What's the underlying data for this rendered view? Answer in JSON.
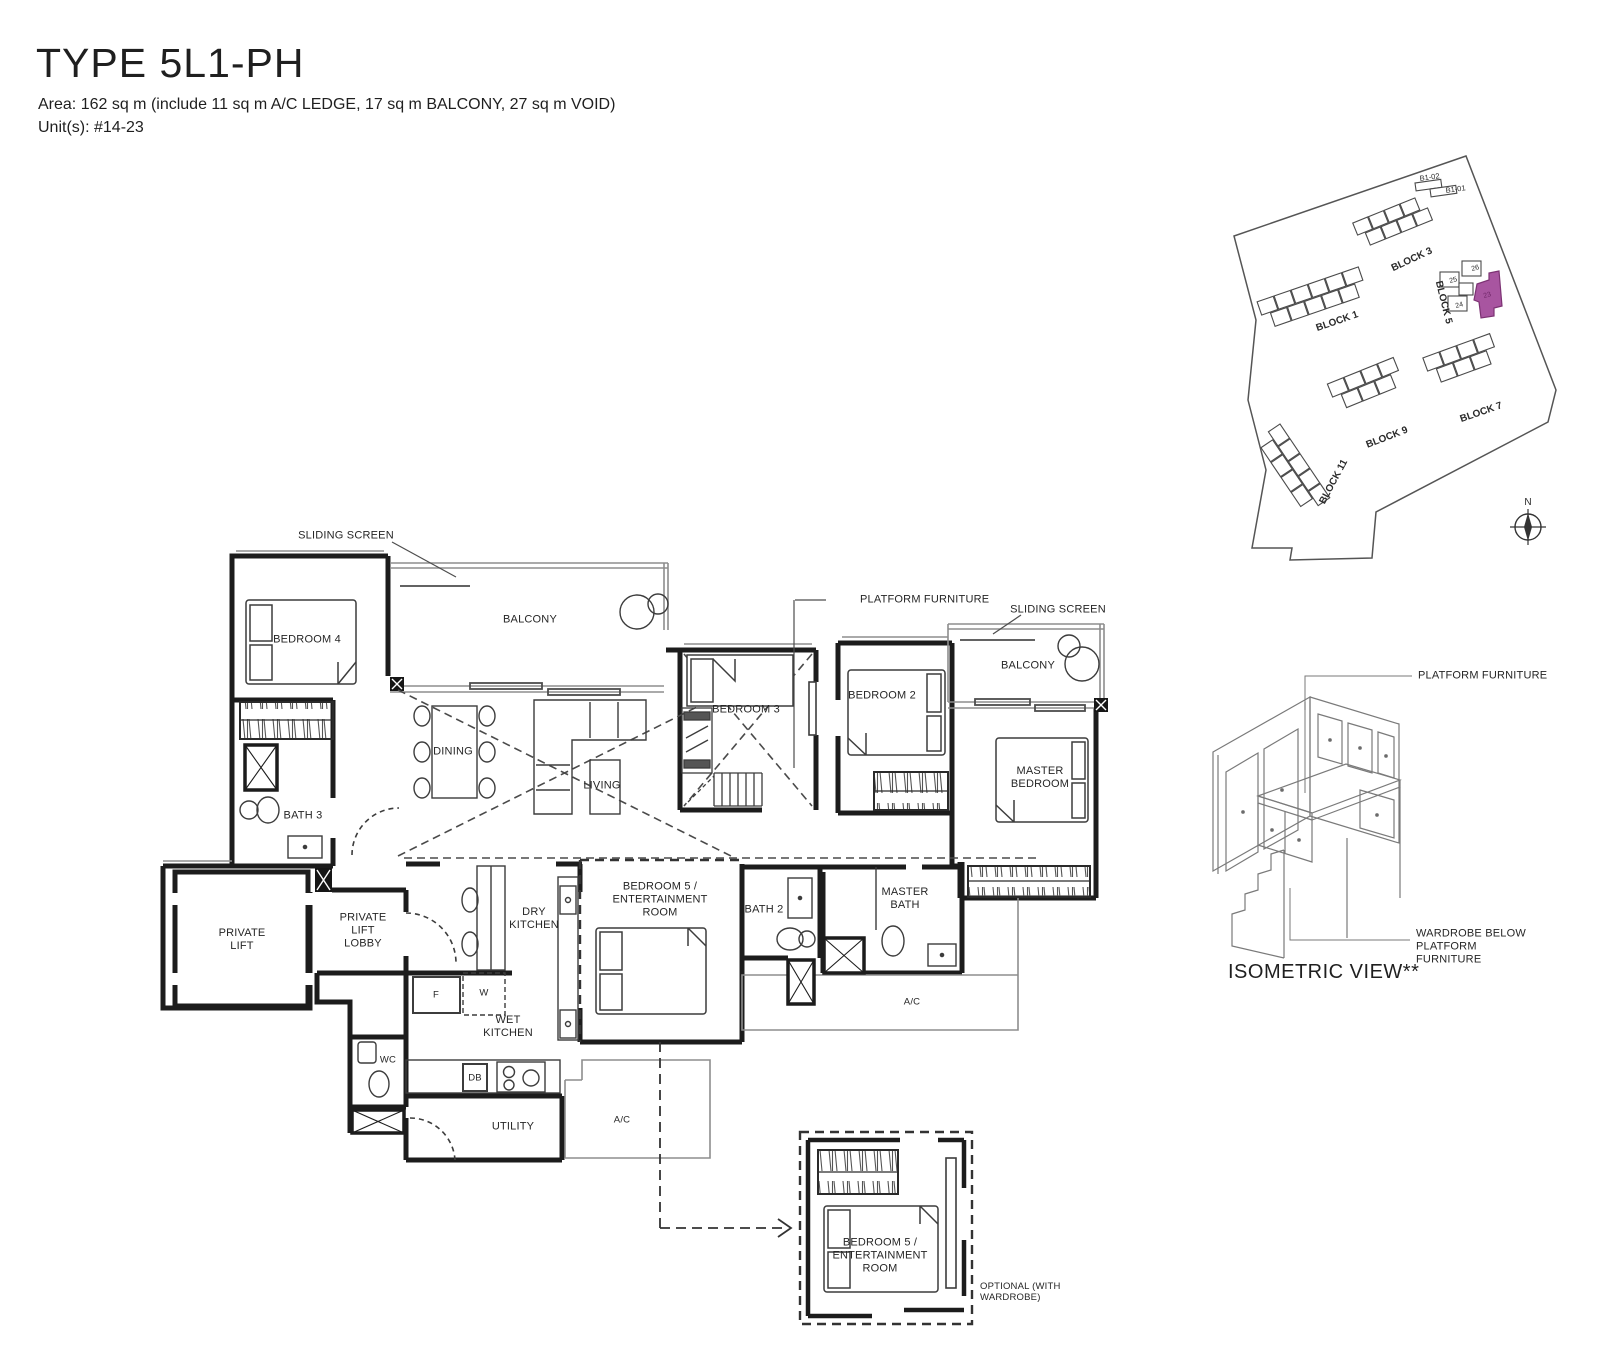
{
  "header": {
    "title": "TYPE 5L1-PH",
    "area": "Area: 162 sq m (include 11 sq m A/C LEDGE, 17 sq m BALCONY, 27 sq m VOID)",
    "units": "Unit(s): #14-23"
  },
  "floor_plan": {
    "annotations": {
      "sliding_screen_left": "SLIDING SCREEN",
      "sliding_screen_right": "SLIDING SCREEN",
      "platform_furniture": "PLATFORM FURNITURE",
      "optional_note": "OPTIONAL (WITH WARDROBE)"
    },
    "rooms": {
      "bedroom4": "BEDROOM 4",
      "balcony_left": "BALCONY",
      "balcony_right": "BALCONY",
      "dining": "DINING",
      "living": "LIVING",
      "bedroom3": "BEDROOM 3",
      "bedroom2": "BEDROOM 2",
      "master_bedroom": "MASTER BEDROOM",
      "bath3": "BATH 3",
      "private_lift": "PRIVATE LIFT",
      "private_lift_lobby": "PRIVATE LIFT LOBBY",
      "dry_kitchen": "DRY KITCHEN",
      "bedroom5": "BEDROOM 5 / ENTERTAINMENT ROOM",
      "bath2": "BATH 2",
      "master_bath": "MASTER BATH",
      "wet_kitchen": "WET KITCHEN",
      "wc": "WC",
      "utility": "UTILITY",
      "ac_side": "A/C",
      "ac_bottom": "A/C",
      "fridge": "F",
      "washer": "W",
      "db": "DB"
    },
    "detail": {
      "room": "BEDROOM 5 / ENTERTAINMENT ROOM"
    }
  },
  "site_plan": {
    "blocks": [
      {
        "label": "BLOCK 1"
      },
      {
        "label": "BLOCK 3"
      },
      {
        "label": "BLOCK 5"
      },
      {
        "label": "BLOCK 7"
      },
      {
        "label": "BLOCK 9"
      },
      {
        "label": "BLOCK 11"
      }
    ],
    "basement": {
      "b1_02": "B1-02",
      "b1_01": "B1-01"
    },
    "units": {
      "u25": "25",
      "u26": "26",
      "u24": "24",
      "highlighted": "23"
    },
    "highlight_color": "#a855a0",
    "compass": "N"
  },
  "isometric": {
    "caption": "ISOMETRIC VIEW**",
    "platform_label": "PLATFORM FURNITURE",
    "wardrobe_label": "WARDROBE BELOW PLATFORM FURNITURE"
  }
}
